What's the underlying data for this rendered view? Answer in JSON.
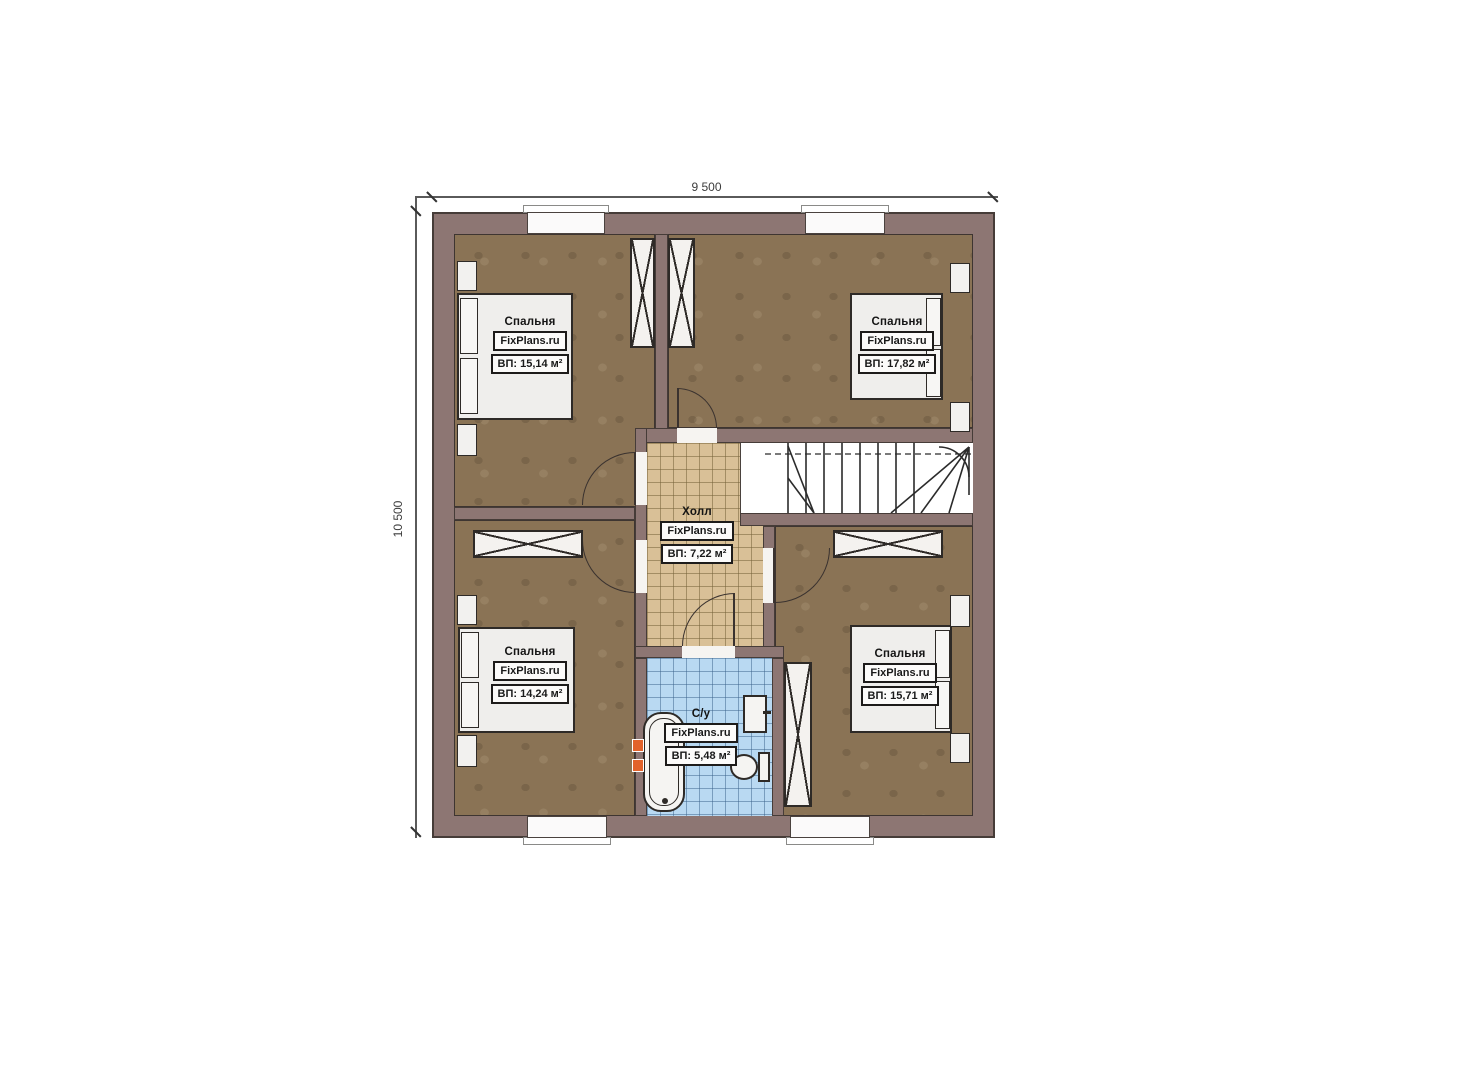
{
  "dimensions": {
    "width_label": "9 500",
    "height_label": "10 500"
  },
  "rooms": {
    "bedroom_tl": {
      "name": "Спальня",
      "brand": "FixPlans.ru",
      "area": "ВП: 15,14 м²"
    },
    "bedroom_tr": {
      "name": "Спальня",
      "brand": "FixPlans.ru",
      "area": "ВП: 17,82 м²"
    },
    "bedroom_bl": {
      "name": "Спальня",
      "brand": "FixPlans.ru",
      "area": "ВП: 14,24 м²"
    },
    "bedroom_br": {
      "name": "Спальня",
      "brand": "FixPlans.ru",
      "area": "ВП: 15,71 м²"
    },
    "hall": {
      "name": "Холл",
      "brand": "FixPlans.ru",
      "area": "ВП: 7,22 м²"
    },
    "bathroom": {
      "name": "С/у",
      "brand": "FixPlans.ru",
      "area": "ВП: 5,48 м²"
    }
  },
  "colors": {
    "wall": "#8d7673",
    "bedroom_floor": "#8a7355",
    "hall_floor": "#d9c097",
    "bath_floor": "#b9d9f2",
    "accent_vent": "#e2622b"
  }
}
